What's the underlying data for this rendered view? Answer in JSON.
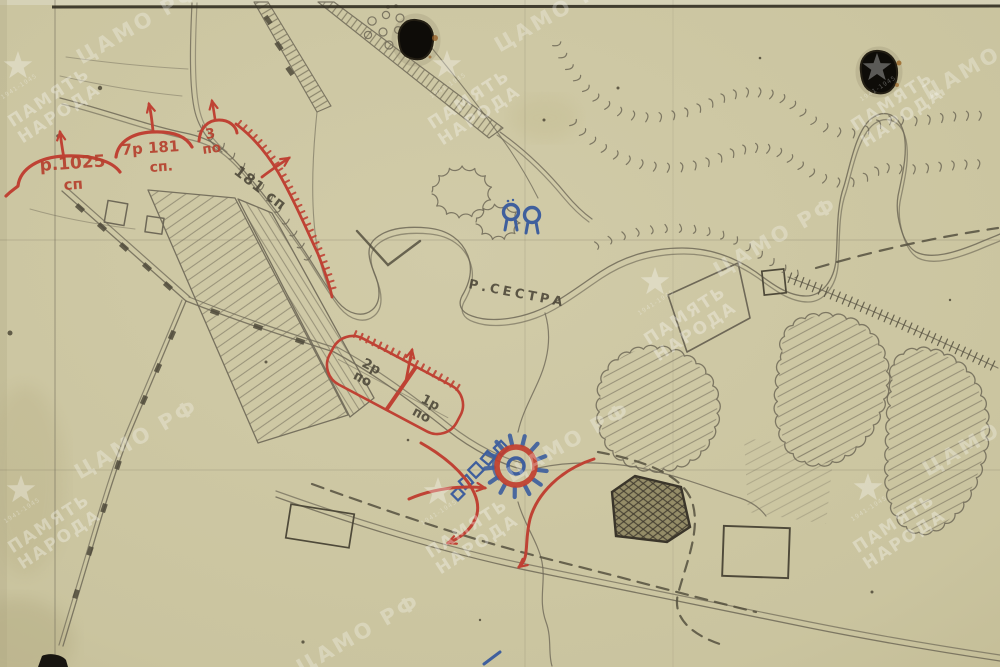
{
  "scan": {
    "title": "Hand-drawn military sketch map (archival scan)",
    "colors": {
      "paper": "#ccc6a2",
      "pencil": "#6e6857",
      "pencil_dark": "#4a4537",
      "red": "#bf4234",
      "blue": "#3f5f9d",
      "watermark": "#ffffff"
    }
  },
  "labels": {
    "river": "Р.СЕСТРА",
    "unit_1025_line1": "р.1025",
    "unit_1025_line2": "сп",
    "unit_7r181_line1": "7р 181",
    "unit_7r181_line2": "сп.",
    "unit_3po_line1": "3",
    "unit_3po_line2": "по",
    "unit_181": "181 сп",
    "box_2r_line1": "2р",
    "box_2r_line2": "по",
    "box_1r_line1": "1р",
    "box_1r_line2": "по"
  },
  "watermark": {
    "line1": "ПАМЯТЬ",
    "line2": "НАРОДА",
    "agency": "ЦАМО РФ",
    "years": "1941-1945"
  }
}
